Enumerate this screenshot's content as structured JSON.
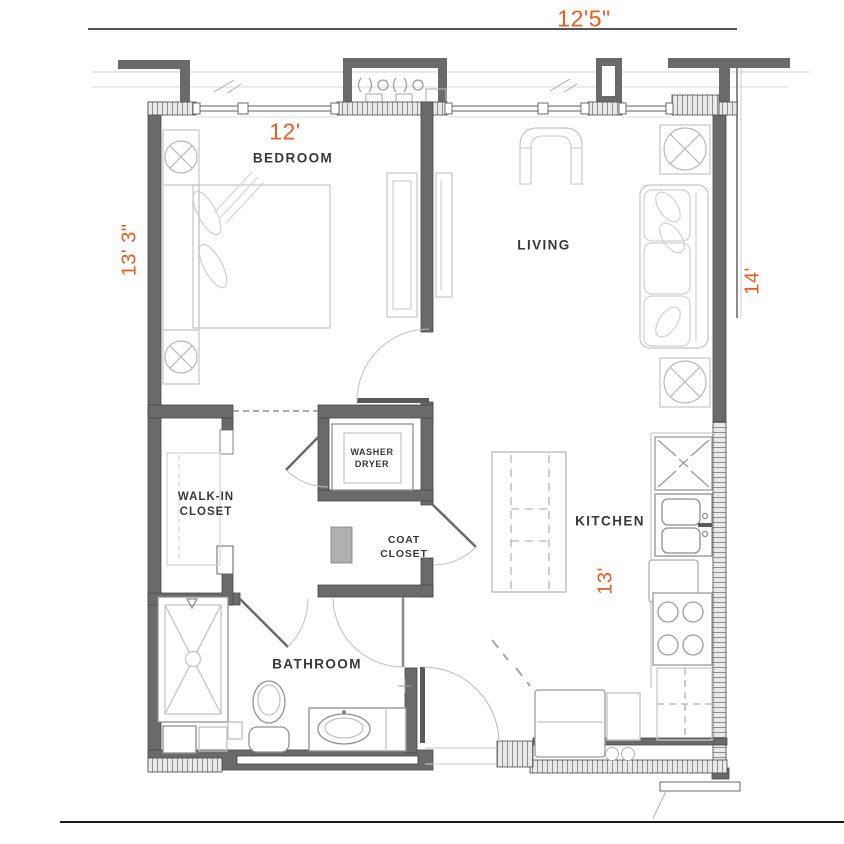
{
  "title": "One bedroom apartment floor plan",
  "colors": {
    "dimension_orange": "#E95C20",
    "wall_gray": "#6A6A6A",
    "label_dark": "#383838",
    "line_light": "#C4C4C4"
  },
  "rooms": {
    "bedroom": {
      "label": "BEDROOM"
    },
    "living": {
      "label": "LIVING"
    },
    "kitchen": {
      "label": "KITCHEN"
    },
    "bathroom": {
      "label": "BATHROOM"
    },
    "walk_in_closet": {
      "label_line1": "WALK-IN",
      "label_line2": "CLOSET"
    },
    "washer_dryer": {
      "label_line1": "WASHER",
      "label_line2": "DRYER"
    },
    "coat_closet": {
      "label_line1": "COAT",
      "label_line2": "CLOSET"
    }
  },
  "dimensions": {
    "top": "12'5\"",
    "bedroom_width": "12'",
    "left_height": "13' 3\"",
    "right_height": "14'",
    "kitchen_length": "13'"
  }
}
